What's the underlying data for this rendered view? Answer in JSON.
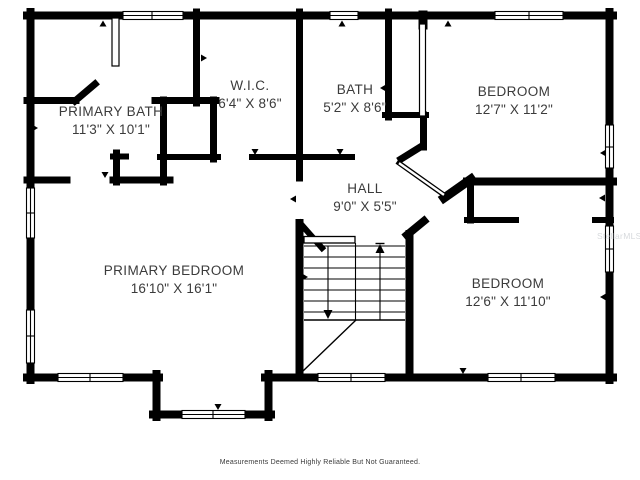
{
  "plan": {
    "colors": {
      "wall": "#000000",
      "background": "#ffffff",
      "label_text": "#3b3b3b"
    },
    "rooms": [
      {
        "id": "primary-bath",
        "name": "PRIMARY BATH",
        "dims": "11'3\" X 10'1\""
      },
      {
        "id": "wic",
        "name": "W.I.C.",
        "dims": "6'4\" X 8'6\""
      },
      {
        "id": "bath",
        "name": "BATH",
        "dims": "5'2\" X 8'6\""
      },
      {
        "id": "bedroom-top-right",
        "name": "BEDROOM",
        "dims": "12'7\" X 11'2\""
      },
      {
        "id": "hall",
        "name": "HALL",
        "dims": "9'0\" X 5'5\""
      },
      {
        "id": "primary-bedroom",
        "name": "PRIMARY BEDROOM",
        "dims": "16'10\" X 16'1\""
      },
      {
        "id": "bedroom-bottom-right",
        "name": "BEDROOM",
        "dims": "12'6\" X 11'10\""
      }
    ],
    "stairs": {
      "up_arrow": "up",
      "down_arrow": "down"
    },
    "disclaimer": "Measurements Deemed Highly Reliable But Not Guaranteed.",
    "watermark": "StellarMLS"
  }
}
